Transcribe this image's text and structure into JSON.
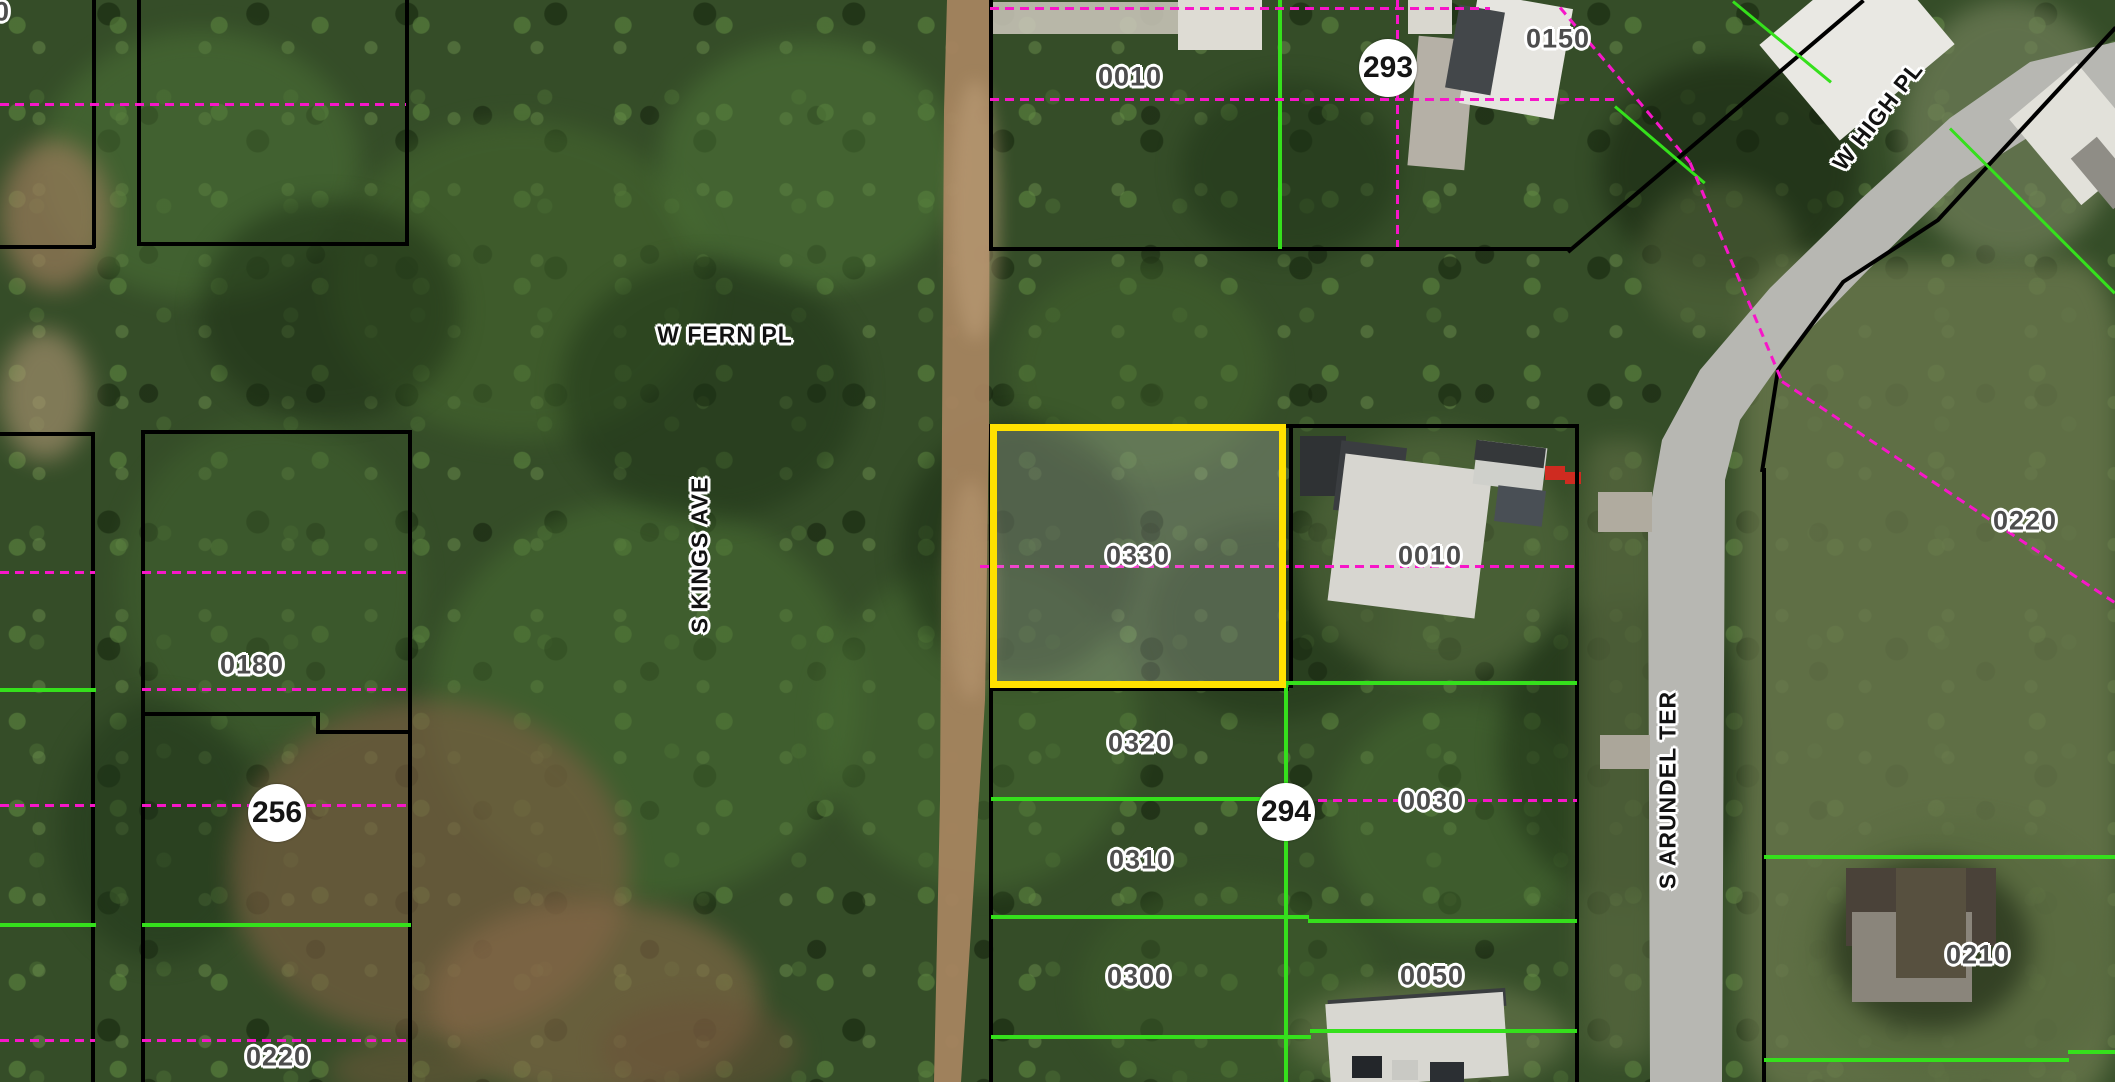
{
  "map": {
    "selected_parcel": {
      "id": "0330"
    },
    "parcel_labels": [
      {
        "text": "0010",
        "x": 1130,
        "y": 77
      },
      {
        "text": "0150",
        "x": 1558,
        "y": 39
      },
      {
        "text": "0330",
        "x": 1138,
        "y": 556
      },
      {
        "text": "0010",
        "x": 1430,
        "y": 556
      },
      {
        "text": "0320",
        "x": 1140,
        "y": 743
      },
      {
        "text": "0030",
        "x": 1432,
        "y": 801
      },
      {
        "text": "0310",
        "x": 1141,
        "y": 860
      },
      {
        "text": "0300",
        "x": 1139,
        "y": 977
      },
      {
        "text": "0050",
        "x": 1432,
        "y": 976
      },
      {
        "text": "0180",
        "x": 252,
        "y": 665
      },
      {
        "text": "0220",
        "x": 278,
        "y": 1057
      },
      {
        "text": "0220",
        "x": 2025,
        "y": 521
      },
      {
        "text": "0210",
        "x": 1978,
        "y": 955
      },
      {
        "text": "0",
        "x": 2,
        "y": 12
      }
    ],
    "section_markers": [
      {
        "text": "293",
        "x": 1388,
        "y": 68
      },
      {
        "text": "294",
        "x": 1286,
        "y": 812
      },
      {
        "text": "256",
        "x": 277,
        "y": 813
      }
    ],
    "street_labels": [
      {
        "text": "W FERN PL",
        "x": 725,
        "y": 335,
        "rot": 0
      },
      {
        "text": "S KINGS AVE",
        "x": 700,
        "y": 555,
        "rot": -90
      },
      {
        "text": "W HIGH PL",
        "x": 1878,
        "y": 116,
        "rot": -52
      },
      {
        "text": "S ARUNDEL TER",
        "x": 1668,
        "y": 790,
        "rot": -90
      }
    ],
    "colors": {
      "highlight": "#ffe100",
      "parcel_line": "#000000",
      "lot_line_green": "#35e01c",
      "boundary_magenta": "#f716c9",
      "marker_bg": "#ffffff",
      "marker_text": "#141414",
      "parcel_label_text": "#4d4d4d",
      "street_label_text": "#121212"
    }
  }
}
